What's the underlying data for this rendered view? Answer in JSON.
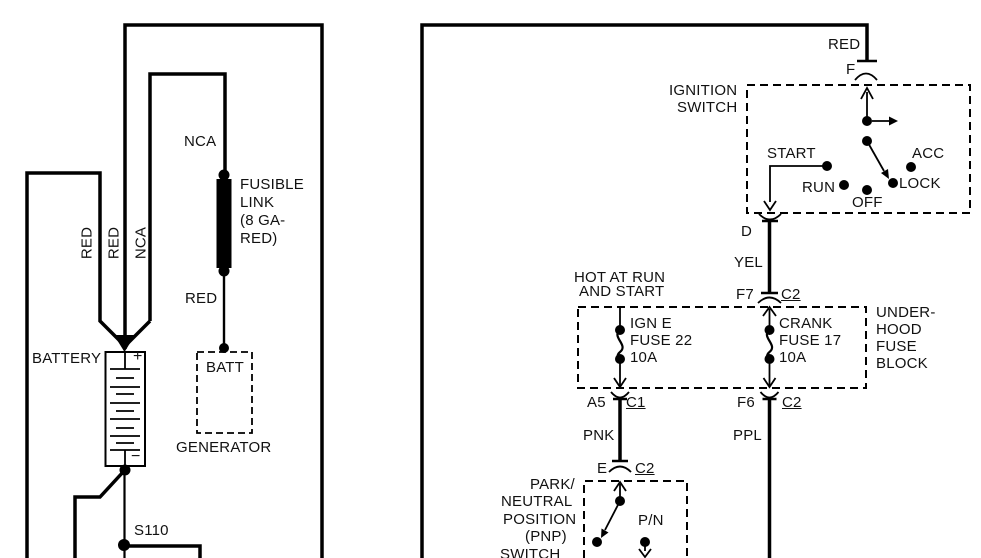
{
  "diagram": {
    "kind": "automotive wiring diagram",
    "background": "#ffffff",
    "ink": "#000000"
  },
  "components": {
    "battery": {
      "label": "BATTERY",
      "plus": "+",
      "minus": "−"
    },
    "generator": {
      "label": "GENERATOR",
      "terminal": "BATT"
    },
    "fusible_link": {
      "label": "FUSIBLE LINK (8 GA- RED)"
    },
    "splice": {
      "label": "S110"
    },
    "ignition_switch": {
      "label": "IGNITION SWITCH",
      "positions": [
        "START",
        "RUN",
        "OFF",
        "ACC",
        "LOCK"
      ],
      "terminals": [
        "F",
        "D"
      ]
    },
    "underhood_fuse_block": {
      "label": "UNDER- HOOD FUSE BLOCK",
      "fuses": [
        "IGN E FUSE 22 10A",
        "CRANK FUSE 17 10A"
      ],
      "feed_note": "HOT AT RUN AND START"
    },
    "pnp_switch": {
      "label": "PARK/ NEUTRAL POSITION (PNP) SWITCH",
      "contact": "P/N"
    },
    "wires": [
      "RED",
      "RED",
      "NCA",
      "RED",
      "YEL",
      "PNK",
      "PPL"
    ]
  },
  "labels": [
    {
      "id": "wire-red-1-label",
      "text": "RED",
      "cx": 87,
      "cy": 243,
      "rotate": -90
    },
    {
      "id": "wire-red-2-label",
      "text": "RED",
      "cx": 114,
      "cy": 243,
      "rotate": -90
    },
    {
      "id": "wire-nca-1-label",
      "text": "NCA",
      "cx": 141,
      "cy": 243,
      "rotate": -90
    },
    {
      "id": "wire-nca-2-label",
      "text": "NCA",
      "x": 184,
      "y": 134
    },
    {
      "id": "fusible-link-label-1",
      "text": "FUSIBLE",
      "x": 240,
      "y": 177
    },
    {
      "id": "fusible-link-label-2",
      "text": "LINK",
      "x": 240,
      "y": 195
    },
    {
      "id": "fusible-link-label-3",
      "text": "(8 GA-",
      "x": 240,
      "y": 213
    },
    {
      "id": "fusible-link-label-4",
      "text": "RED)",
      "x": 240,
      "y": 231
    },
    {
      "id": "wire-red-generator-label",
      "text": "RED",
      "x": 185,
      "y": 291
    },
    {
      "id": "battery-label",
      "text": "BATTERY",
      "x": 32,
      "y": 351
    },
    {
      "id": "battery-plus-sign",
      "text": "+",
      "x": 133,
      "y": 349,
      "size": 16
    },
    {
      "id": "battery-minus-sign",
      "text": "−",
      "x": 131,
      "y": 449,
      "size": 16
    },
    {
      "id": "generator-batt-terminal-label",
      "text": "BATT",
      "x": 206,
      "y": 360
    },
    {
      "id": "generator-label",
      "text": "GENERATOR",
      "x": 176,
      "y": 440
    },
    {
      "id": "splice-s110-label",
      "text": "S110",
      "x": 134,
      "y": 523
    },
    {
      "id": "wire-red-ignition-label",
      "text": "RED",
      "x": 828,
      "y": 37
    },
    {
      "id": "terminal-f-label",
      "text": "F",
      "x": 846,
      "y": 62
    },
    {
      "id": "ignition-switch-label-1",
      "text": "IGNITION",
      "x": 669,
      "y": 83
    },
    {
      "id": "ignition-switch-label-2",
      "text": "SWITCH",
      "x": 677,
      "y": 100
    },
    {
      "id": "position-start-label",
      "text": "START",
      "x": 767,
      "y": 146
    },
    {
      "id": "position-acc-label",
      "text": "ACC",
      "x": 912,
      "y": 146
    },
    {
      "id": "position-run-label",
      "text": "RUN",
      "x": 802,
      "y": 180
    },
    {
      "id": "position-lock-label",
      "text": "LOCK",
      "x": 899,
      "y": 176
    },
    {
      "id": "position-off-label",
      "text": "OFF",
      "x": 852,
      "y": 195
    },
    {
      "id": "terminal-d-label",
      "text": "D",
      "x": 741,
      "y": 224
    },
    {
      "id": "wire-yel-label",
      "text": "YEL",
      "x": 734,
      "y": 255
    },
    {
      "id": "hot-at-run-label-1",
      "text": "HOT AT RUN",
      "x": 574,
      "y": 270
    },
    {
      "id": "hot-at-run-label-2",
      "text": "AND START",
      "x": 579,
      "y": 284
    },
    {
      "id": "terminal-f7-label",
      "text": "F7",
      "x": 736,
      "y": 287
    },
    {
      "id": "connector-c2-top-label",
      "text": "C2",
      "x": 781,
      "y": 287,
      "underline": true
    },
    {
      "id": "fuse-ign-e-label-1",
      "text": "IGN E",
      "x": 630,
      "y": 316
    },
    {
      "id": "fuse-ign-e-label-2",
      "text": "FUSE 22",
      "x": 630,
      "y": 333
    },
    {
      "id": "fuse-ign-e-label-3",
      "text": "10A",
      "x": 630,
      "y": 350
    },
    {
      "id": "fuse-crank-label-1",
      "text": "CRANK",
      "x": 779,
      "y": 316
    },
    {
      "id": "fuse-crank-label-2",
      "text": "FUSE 17",
      "x": 779,
      "y": 333
    },
    {
      "id": "fuse-crank-label-3",
      "text": "10A",
      "x": 779,
      "y": 350
    },
    {
      "id": "fuse-block-label-1",
      "text": "UNDER-",
      "x": 876,
      "y": 305
    },
    {
      "id": "fuse-block-label-2",
      "text": "HOOD",
      "x": 876,
      "y": 322
    },
    {
      "id": "fuse-block-label-3",
      "text": "FUSE",
      "x": 876,
      "y": 339
    },
    {
      "id": "fuse-block-label-4",
      "text": "BLOCK",
      "x": 876,
      "y": 356
    },
    {
      "id": "terminal-a5-label",
      "text": "A5",
      "x": 587,
      "y": 395
    },
    {
      "id": "connector-c1-label",
      "text": "C1",
      "x": 626,
      "y": 395,
      "underline": true
    },
    {
      "id": "terminal-f6-label",
      "text": "F6",
      "x": 737,
      "y": 395
    },
    {
      "id": "connector-c2-mid-label",
      "text": "C2",
      "x": 782,
      "y": 395,
      "underline": true
    },
    {
      "id": "wire-pnk-label",
      "text": "PNK",
      "x": 583,
      "y": 428
    },
    {
      "id": "wire-ppl-label",
      "text": "PPL",
      "x": 733,
      "y": 428
    },
    {
      "id": "terminal-e-label",
      "text": "E",
      "x": 597,
      "y": 461
    },
    {
      "id": "connector-c2-bottom-label",
      "text": "C2",
      "x": 635,
      "y": 461,
      "underline": true
    },
    {
      "id": "pnp-switch-label-1",
      "text": "PARK/",
      "x": 530,
      "y": 477
    },
    {
      "id": "pnp-switch-label-2",
      "text": "NEUTRAL",
      "x": 501,
      "y": 494
    },
    {
      "id": "pnp-switch-label-3",
      "text": "POSITION",
      "x": 503,
      "y": 512
    },
    {
      "id": "pnp-switch-label-4",
      "text": "(PNP)",
      "x": 525,
      "y": 529
    },
    {
      "id": "pnp-switch-label-5",
      "text": "SWITCH",
      "x": 500,
      "y": 547
    },
    {
      "id": "contact-pn-label",
      "text": "P/N",
      "x": 638,
      "y": 513
    }
  ]
}
